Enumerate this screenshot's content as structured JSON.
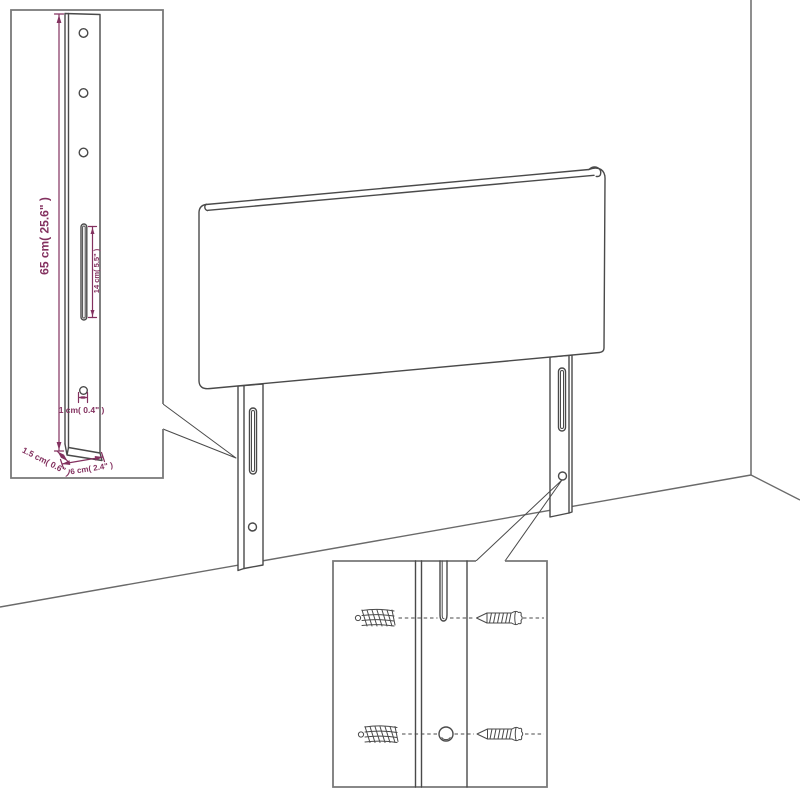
{
  "page": {
    "type": "product-dimension-diagram",
    "subject": "headboard with wall-mount legs leaning against a room corner",
    "views": {
      "main": "headboard panel with two slotted legs against wall",
      "leg_detail_inset": "enlarged leg with holes, slot and dimensions",
      "hardware_detail_inset": "wall plugs and screws aligned to leg slot and hole"
    }
  },
  "colors": {
    "background": "#ffffff",
    "dimension_accent": "#83315f",
    "product_line": "#4a4a4a",
    "wall_line": "#8f8f8f",
    "floor_line": "#6a6a6a",
    "inset_border": "#787878"
  },
  "labels": {
    "leg_height": "65 cm( 25.6\" )",
    "slot_length": "14 cm( 5.5\" )",
    "hole_diameter": "1 cm( 0.4\" )",
    "leg_thickness": "1.5 cm( 0.6\" )",
    "leg_width": "6 cm( 2.4\" )"
  }
}
